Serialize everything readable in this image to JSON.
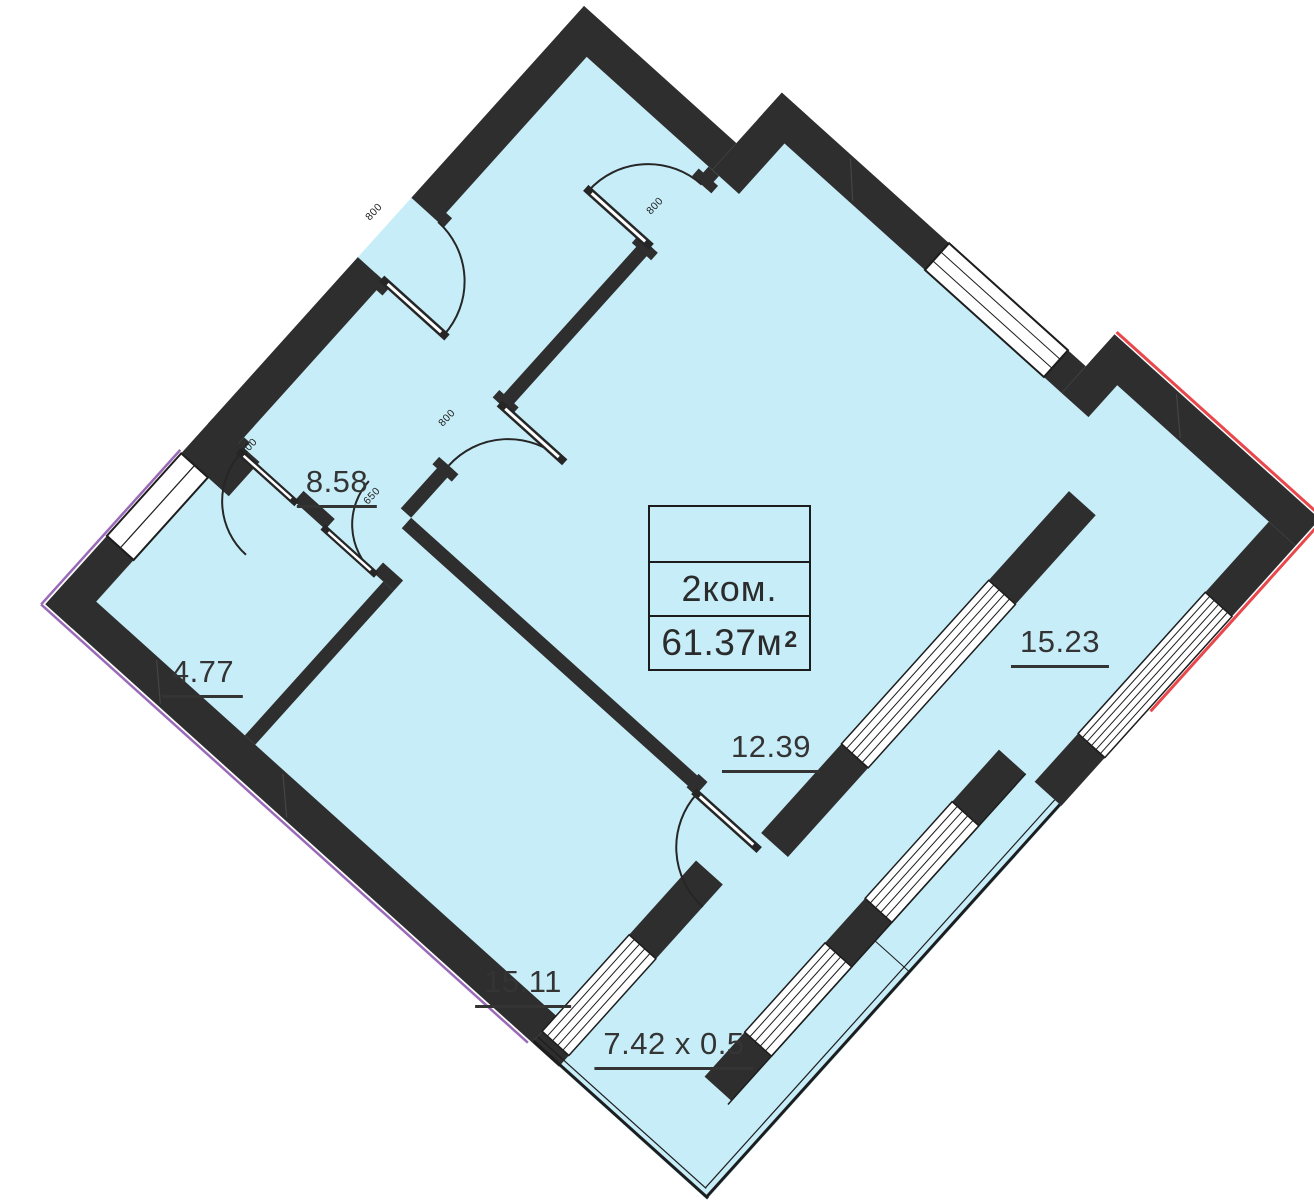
{
  "title": "2-room apartment floor plan",
  "unit_card": {
    "rooms_label": "2ком.",
    "area_value": "61.37",
    "area_unit": "м",
    "area_sup": "2"
  },
  "rooms": [
    {
      "name": "hallway",
      "area": "8.58"
    },
    {
      "name": "bathroom",
      "area": "4.77"
    },
    {
      "name": "kitchen",
      "area": "15.23"
    },
    {
      "name": "bedroom",
      "area": "12.39"
    },
    {
      "name": "living-room",
      "area": "15.11"
    }
  ],
  "balcony": {
    "dimensions": "7.42 x 0.5"
  },
  "door_dimensions": [
    {
      "value": "800",
      "location": "entrance-door"
    },
    {
      "value": "800",
      "location": "hall-top-door"
    },
    {
      "value": "800",
      "location": "bedroom-door"
    },
    {
      "value": "800",
      "location": "bathroom-left-door"
    },
    {
      "value": "650",
      "location": "bathroom-right-door"
    }
  ],
  "colors": {
    "room_fill": "#c7edf8",
    "walls": "#2e2e2e",
    "accent_red": "#e8474b",
    "accent_purple": "#9a6ab8",
    "text": "#343434"
  }
}
